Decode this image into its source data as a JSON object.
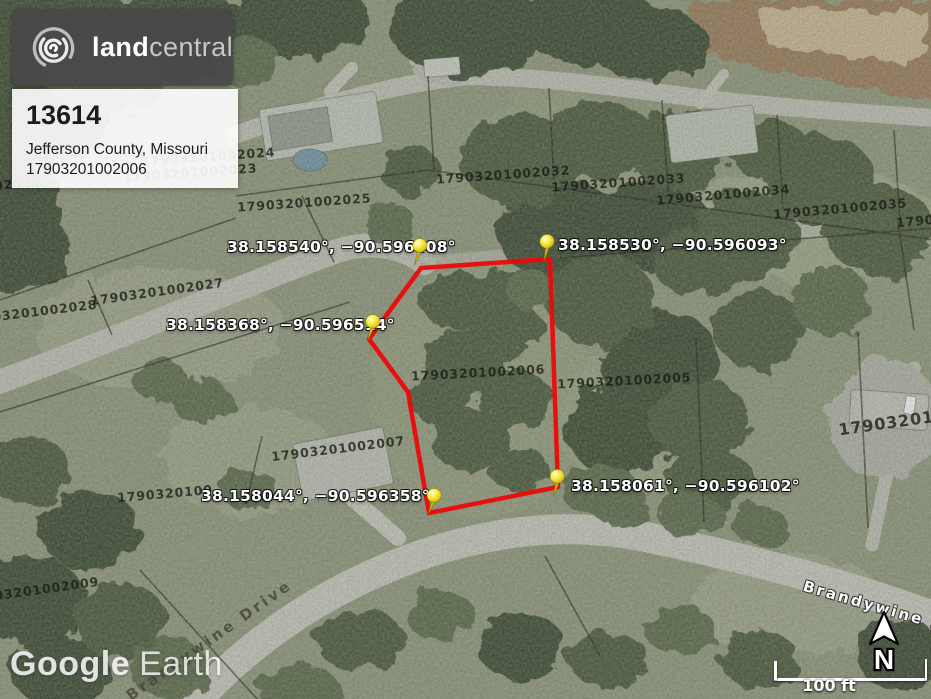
{
  "branding": {
    "logo_bold": "land",
    "logo_light": "central",
    "logo_icon": "swirl-logo"
  },
  "listing": {
    "id": "13614",
    "location": "Jefferson County, Missouri",
    "apn": "17903201002006"
  },
  "pins": [
    {
      "label": "38.158540°, −90.596408°"
    },
    {
      "label": "38.158530°, −90.596093°"
    },
    {
      "label": "38.158368°, −90.596514°"
    },
    {
      "label": "38.158044°, −90.596358°"
    },
    {
      "label": "38.158061°, −90.596102°"
    }
  ],
  "parcel_labels": [
    "17903201002032",
    "17903201002033",
    "17903201002034",
    "17903201002035",
    "17903",
    "17903201002025",
    "17903201002027",
    "03201002028",
    "17903201002006",
    "17903201002005",
    "17903201002007",
    "1790320100",
    "03201002009",
    "1790320100",
    "17903201002024",
    "17903201002023",
    "02022"
  ],
  "streets": [
    "Brandywine Dr",
    "Brandywine Drive"
  ],
  "watermark": {
    "word1": "Google",
    "word2": "Earth"
  },
  "map_controls": {
    "north_label": "N",
    "scale_label": "100 ft"
  },
  "colors": {
    "parcel_boundary": "#ea0a0a",
    "pin": "#f6ec3e",
    "logo_box": "#484848"
  }
}
